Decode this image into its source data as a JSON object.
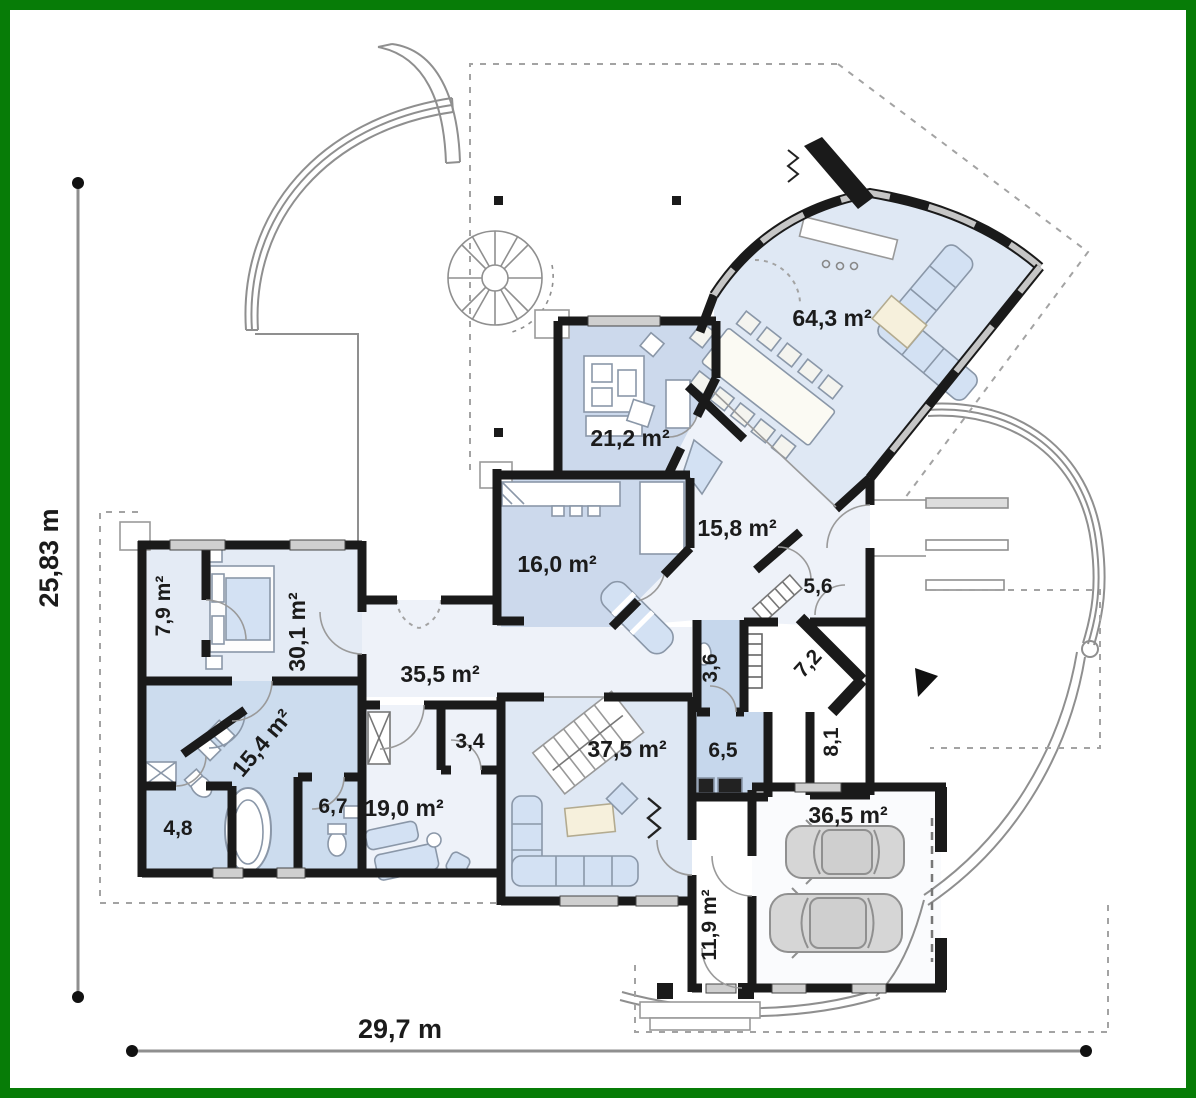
{
  "title": "single-storey house floor plan",
  "dimensions": {
    "height_label": "25,83 m",
    "width_label": "29,7 m"
  },
  "rooms": {
    "living_dining": "64,3 m²",
    "office": "21,2 m²",
    "hall": "15,8 m²",
    "kitchen": "16,0 m²",
    "vestibule": "5,6",
    "wardrobe": "7,9 m²",
    "bedroom": "30,1 m²",
    "corridor": "35,5 m²",
    "bathroom": "15,4 m²",
    "wc_small": "3,6",
    "boiler_room": "7,2",
    "closet": "3,4",
    "family_room": "37,5 m²",
    "laundry": "6,5",
    "pantry": "8,1",
    "toilet": "6,7",
    "lounge": "19,0 m²",
    "storage": "4,8",
    "garage": "36,5 m²",
    "utility_hall": "11,9 m²"
  },
  "colors": {
    "frame_green": "#077c07",
    "wall_black": "#1a1a1a",
    "room_blue": "#ccd9ec",
    "room_blue_soft": "#dfe8f4",
    "room_blue_deep": "#c6d7ec",
    "room_pale": "#eef2f9",
    "furniture_blue": "#d3e1f3",
    "furniture_cream": "#f6f0dc",
    "window_gray": "#c6c6c6",
    "line_gray": "#8f8f8f",
    "car_gray": "#d6d6d6"
  }
}
